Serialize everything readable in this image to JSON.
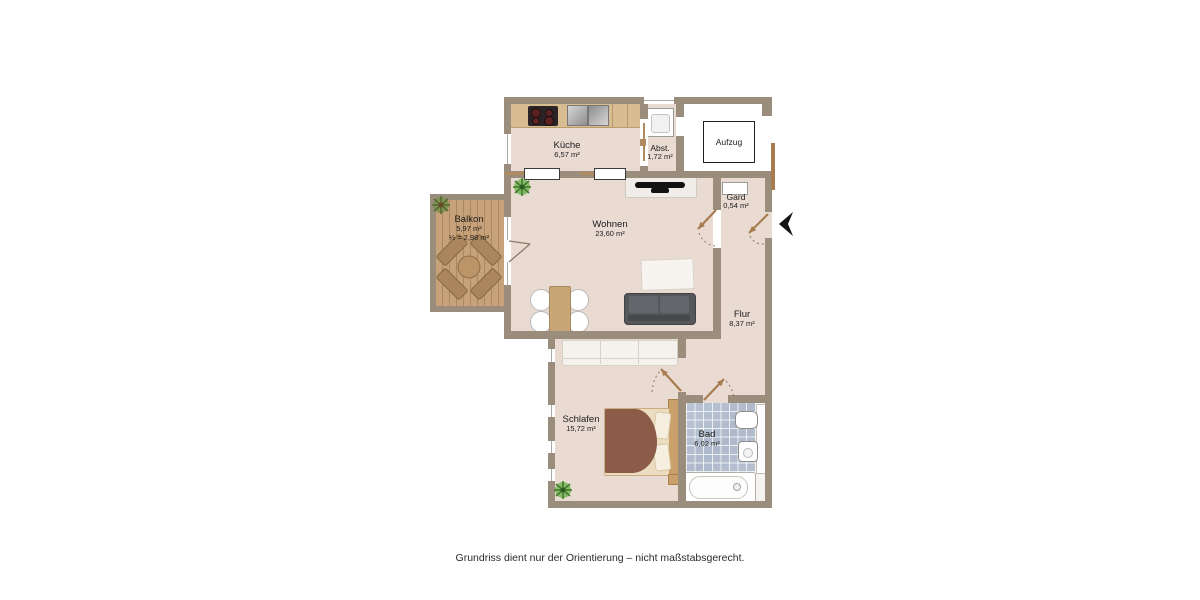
{
  "caption": "Grundriss dient nur der Orientierung – nicht maßstabsgerecht.",
  "rooms": [
    {
      "id": "kueche",
      "name": "Küche",
      "area": "6,57 m²"
    },
    {
      "id": "abstellraum",
      "name": "Abst.",
      "area": "1,72 m²"
    },
    {
      "id": "aufzug",
      "name": "Aufzug",
      "area": ""
    },
    {
      "id": "garderobe",
      "name": "Gard",
      "area": "0,54 m²"
    },
    {
      "id": "wohnen",
      "name": "Wohnen",
      "area": "23,60 m²"
    },
    {
      "id": "flur",
      "name": "Flur",
      "area": "8,37 m²"
    },
    {
      "id": "schlafen",
      "name": "Schlafen",
      "area": "15,72 m²"
    },
    {
      "id": "bad",
      "name": "Bad",
      "area": "6,02 m²"
    },
    {
      "id": "balkon",
      "name": "Balkon",
      "area": "5,97 m²",
      "area_half": "½ = 2,98 m²"
    }
  ],
  "colors": {
    "wall": "#9a8d7b",
    "floor": "#e9dad2",
    "kitchen_counter": "#d9bd92",
    "balcony_deck": "#c6a179",
    "bath_tile": "#b4bfcf",
    "door_leaf": "#a97c50",
    "sofa": "#55575a",
    "bed_blanket": "#8d5c49",
    "entrance_arrow": "#141414"
  }
}
